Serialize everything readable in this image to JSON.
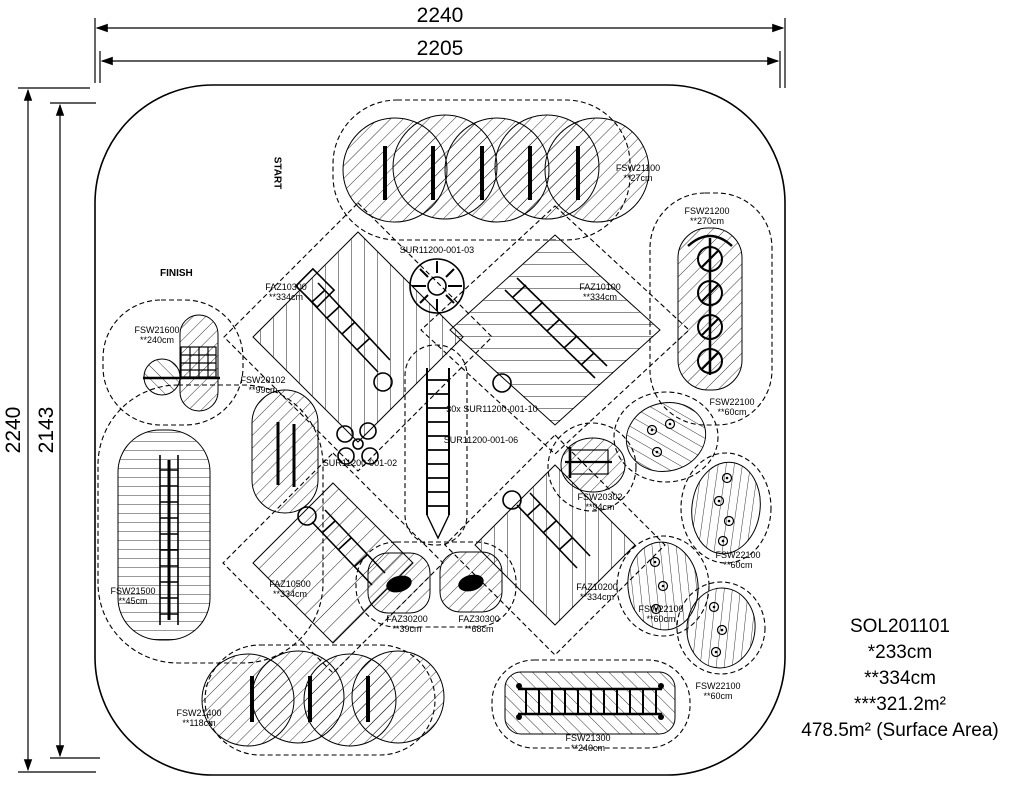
{
  "dims": {
    "top_outer": "2240",
    "top_inner": "2205",
    "left_outer": "2240",
    "left_inner": "2143"
  },
  "markers": {
    "start": "START",
    "finish": "FINISH"
  },
  "product": {
    "code": "SOL201101",
    "star1": "*233cm",
    "star2": "**334cm",
    "star3": "***321.2m²",
    "surface": "478.5m² (Surface Area)"
  },
  "labels": [
    {
      "code": "FSW21100",
      "value": "**27cm"
    },
    {
      "code": "FSW21200",
      "value": "**270cm"
    },
    {
      "code": "FAZ10300",
      "value": "**334cm"
    },
    {
      "code": "FAZ10100",
      "value": "**334cm"
    },
    {
      "code": "SUR11200-001-03",
      "value": ""
    },
    {
      "code": "FSW21600",
      "value": "**240cm"
    },
    {
      "code": "FSW20102",
      "value": "**99cm"
    },
    {
      "code": "30x SUR11200-001-10",
      "value": ""
    },
    {
      "code": "SUR11200-001-06",
      "value": ""
    },
    {
      "code": "SUR11200-001-02",
      "value": ""
    },
    {
      "code": "FSW20302",
      "value": "**94cm"
    },
    {
      "code": "FSW22100",
      "value": "**60cm"
    },
    {
      "code": "FSW22100",
      "value": "**60cm"
    },
    {
      "code": "FSW22100",
      "value": "**60cm"
    },
    {
      "code": "FSW22100",
      "value": "**60cm"
    },
    {
      "code": "FAZ10500",
      "value": "**334cm"
    },
    {
      "code": "FAZ10200",
      "value": "**334cm"
    },
    {
      "code": "FAZ30200",
      "value": "**39cm"
    },
    {
      "code": "FAZ30300",
      "value": "**68cm"
    },
    {
      "code": "FSW21500",
      "value": "**45cm"
    },
    {
      "code": "FSW21400",
      "value": "**118cm"
    },
    {
      "code": "FSW21300",
      "value": "**240cm"
    }
  ]
}
